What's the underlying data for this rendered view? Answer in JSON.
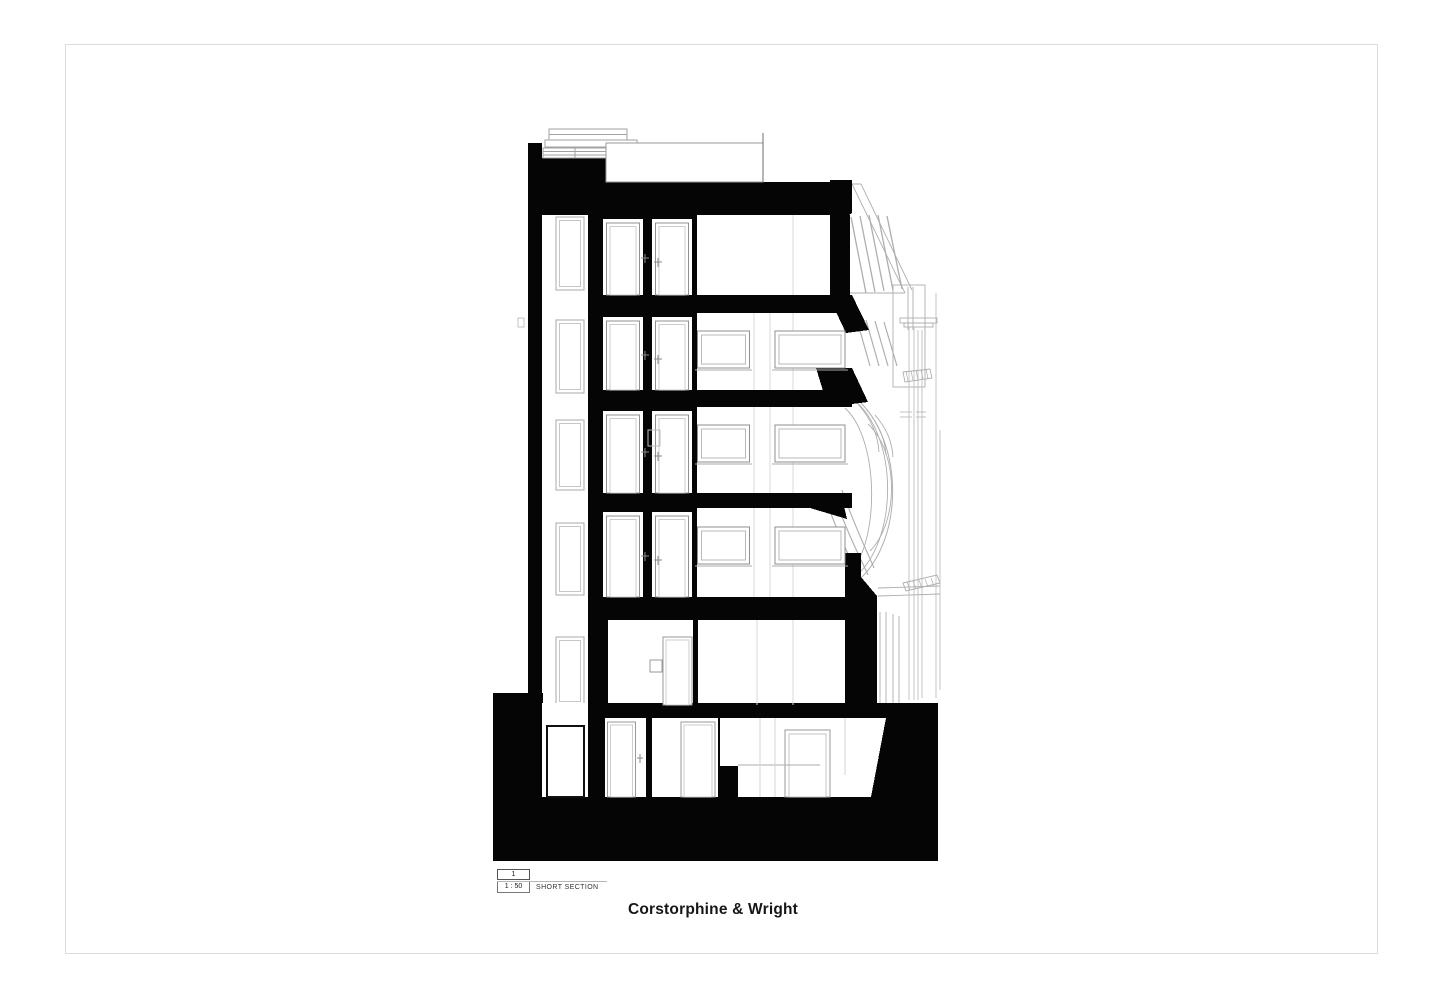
{
  "sheet": {
    "background": "#ffffff",
    "border_color": "#dcdcdc"
  },
  "title_block": {
    "drawing_number": "1",
    "scale": "1 : 50",
    "drawing_title": "SHORT SECTION"
  },
  "branding": {
    "firm_name": "Corstorphine & Wright",
    "text_color": "#161616"
  },
  "drawing": {
    "ink_color": "#050505",
    "line_color": "#a8a8a8",
    "levels_visible": 6
  }
}
